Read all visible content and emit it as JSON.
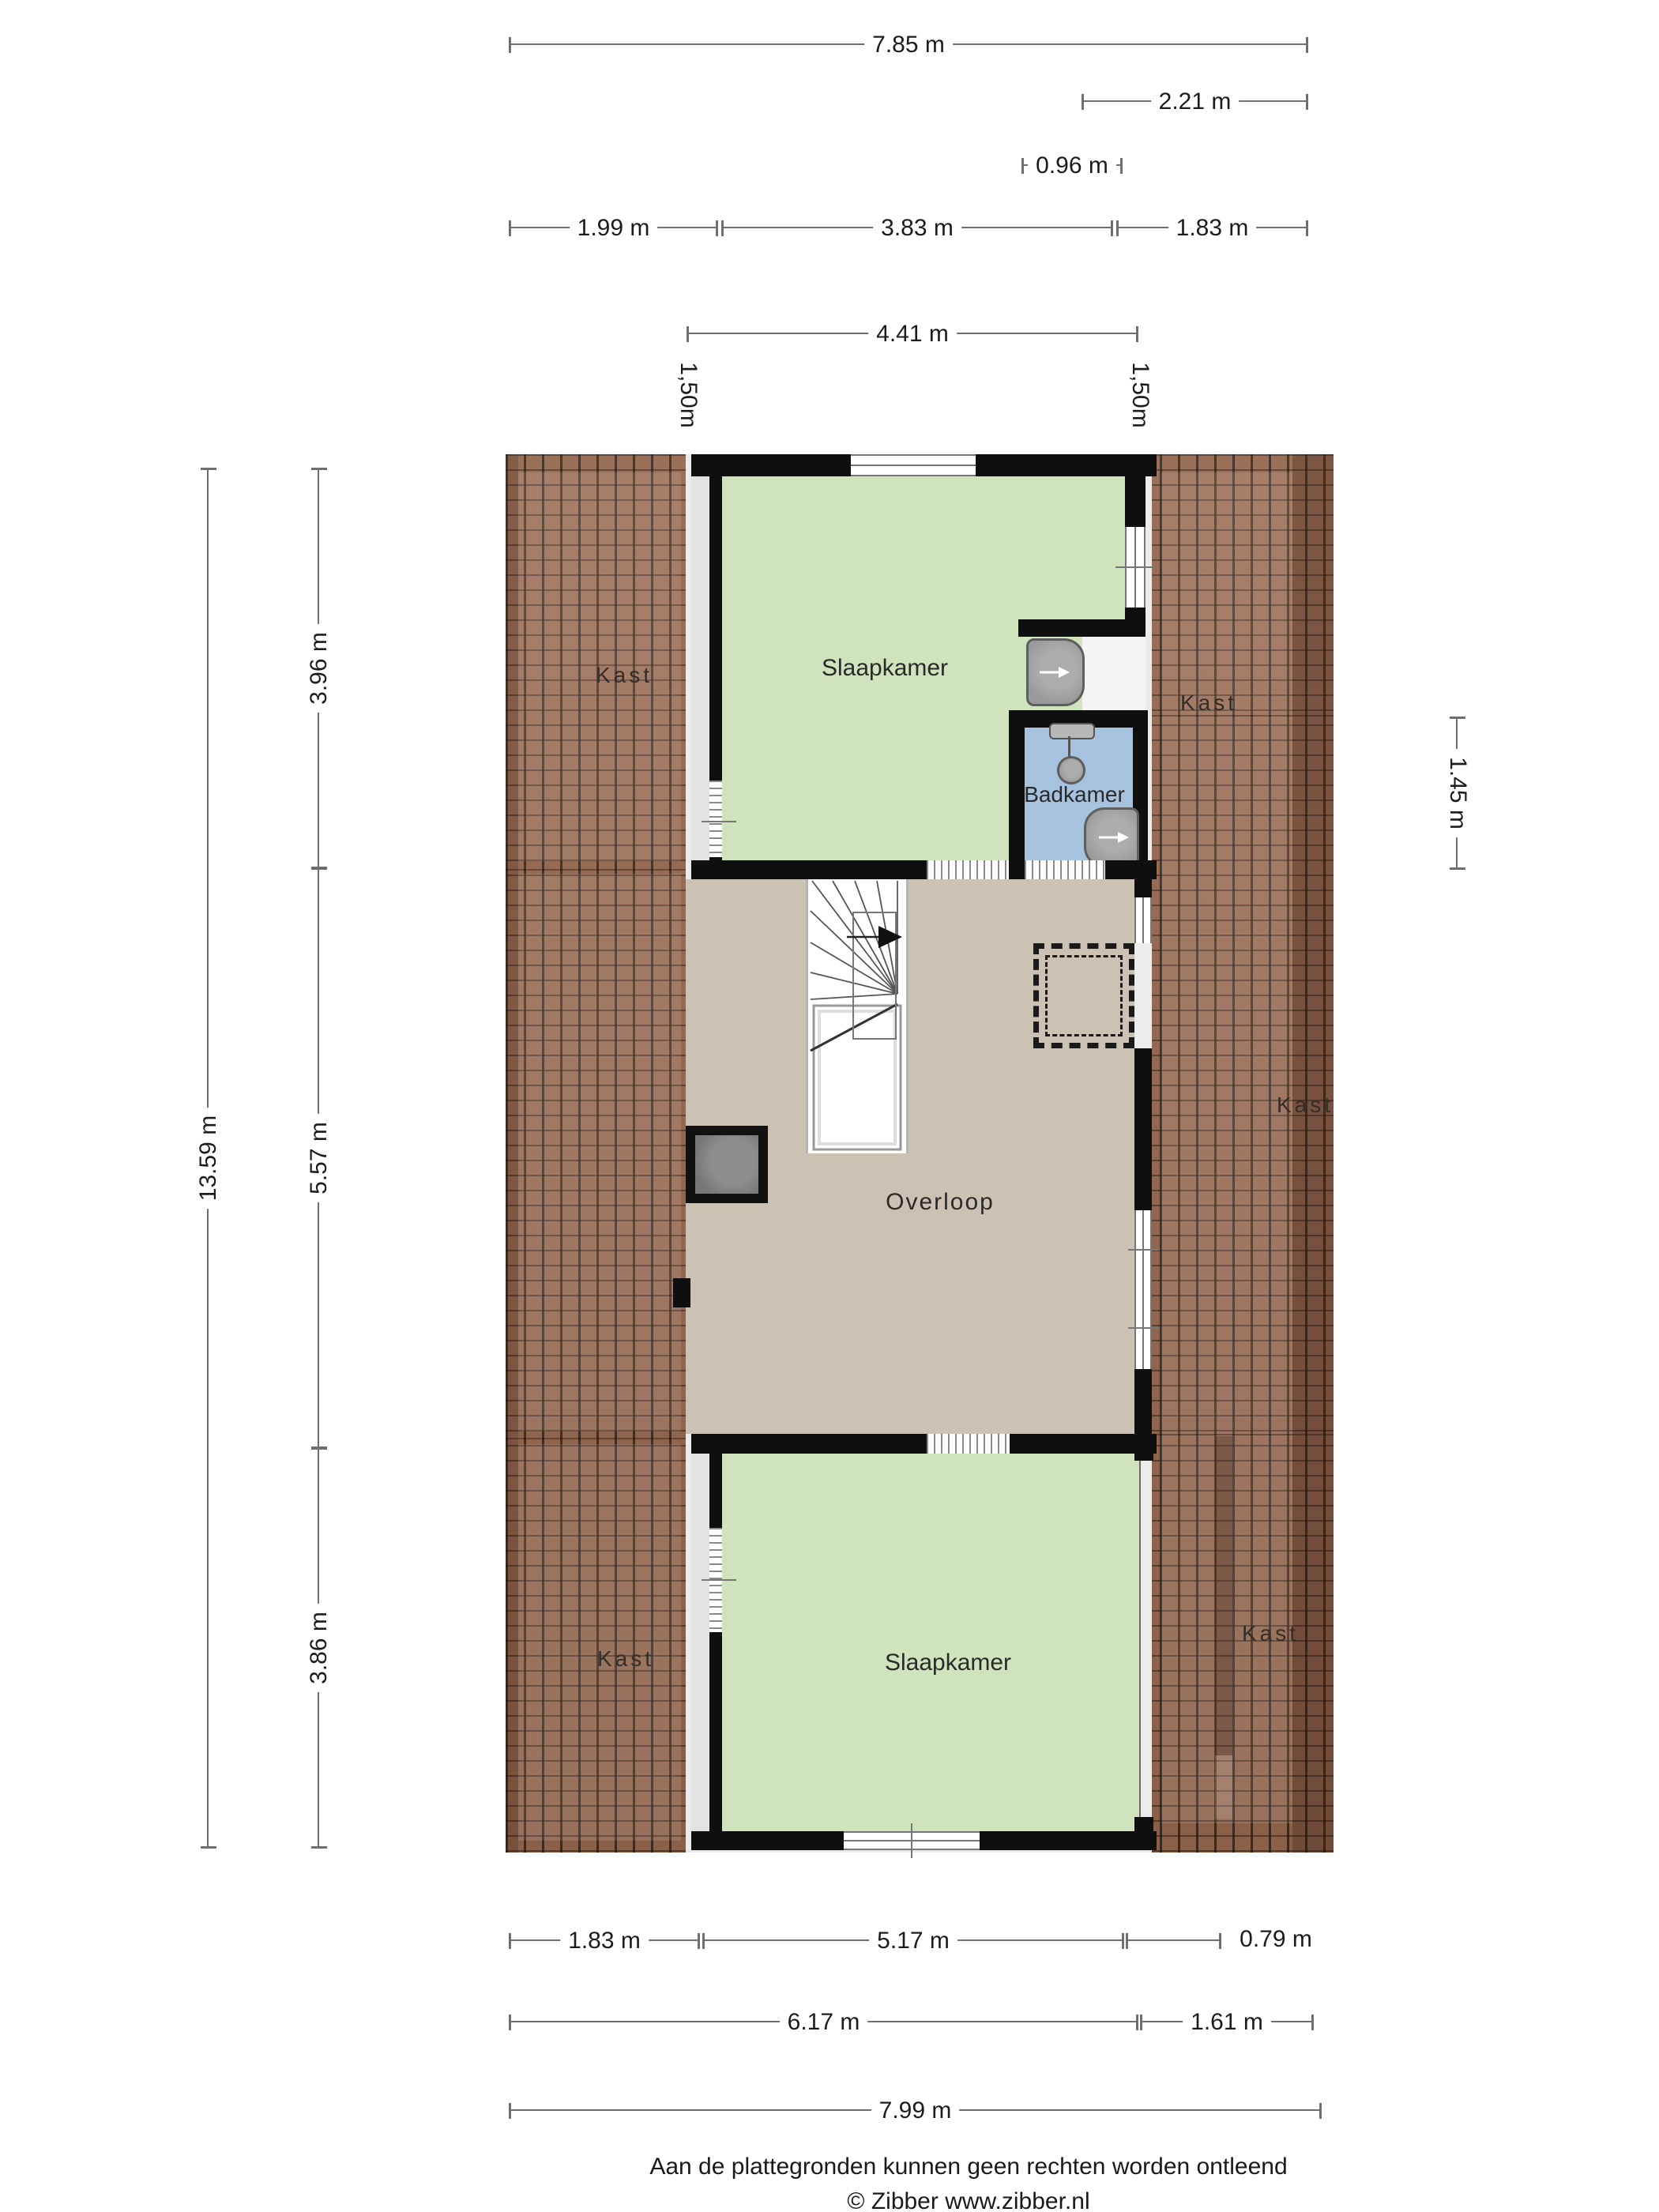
{
  "rooms": {
    "bedroom_top": "Slaapkamer",
    "bedroom_bottom": "Slaapkamer",
    "bathroom": "Badkamer",
    "landing": "Overloop"
  },
  "closets": {
    "top_left": "Kast",
    "top_right": "Kast",
    "mid_right": "Kast",
    "bottom_left": "Kast",
    "bottom_right": "Kast"
  },
  "dimensions": {
    "top": {
      "d785": "7.85 m",
      "d221": "2.21 m",
      "d096": "0.96 m",
      "d199": "1.99 m",
      "d383": "3.83 m",
      "d183": "1.83 m",
      "d441": "4.41 m",
      "d150_left": "1,50m",
      "d150_right": "1,50m"
    },
    "left": {
      "d1359": "13.59 m",
      "d396": "3.96 m",
      "d557": "5.57 m",
      "d386": "3.86 m"
    },
    "right": {
      "d145": "1.45 m"
    },
    "bottom": {
      "d183": "1.83 m",
      "d517": "5.17 m",
      "d079": "0.79 m",
      "d617": "6.17 m",
      "d161": "1.61 m",
      "d799": "7.99 m"
    }
  },
  "footer": {
    "disclaimer": "Aan de plattegronden kunnen geen rechten worden ontleend",
    "credit": "© Zibber www.zibber.nl"
  },
  "colors": {
    "wall": "#0f0f0f",
    "brick": "#96684f",
    "green": "#cfe3bc",
    "blue": "#a7c2df",
    "beige": "#ccc2b3",
    "underlay": "#ececec",
    "strip": "#e3e3e3",
    "dim_line": "#6e6e6e",
    "text": "#1c1c1c",
    "fixture": "#9a9a9a",
    "fixture_border": "#5e5e5e",
    "chimney": "#767676"
  }
}
